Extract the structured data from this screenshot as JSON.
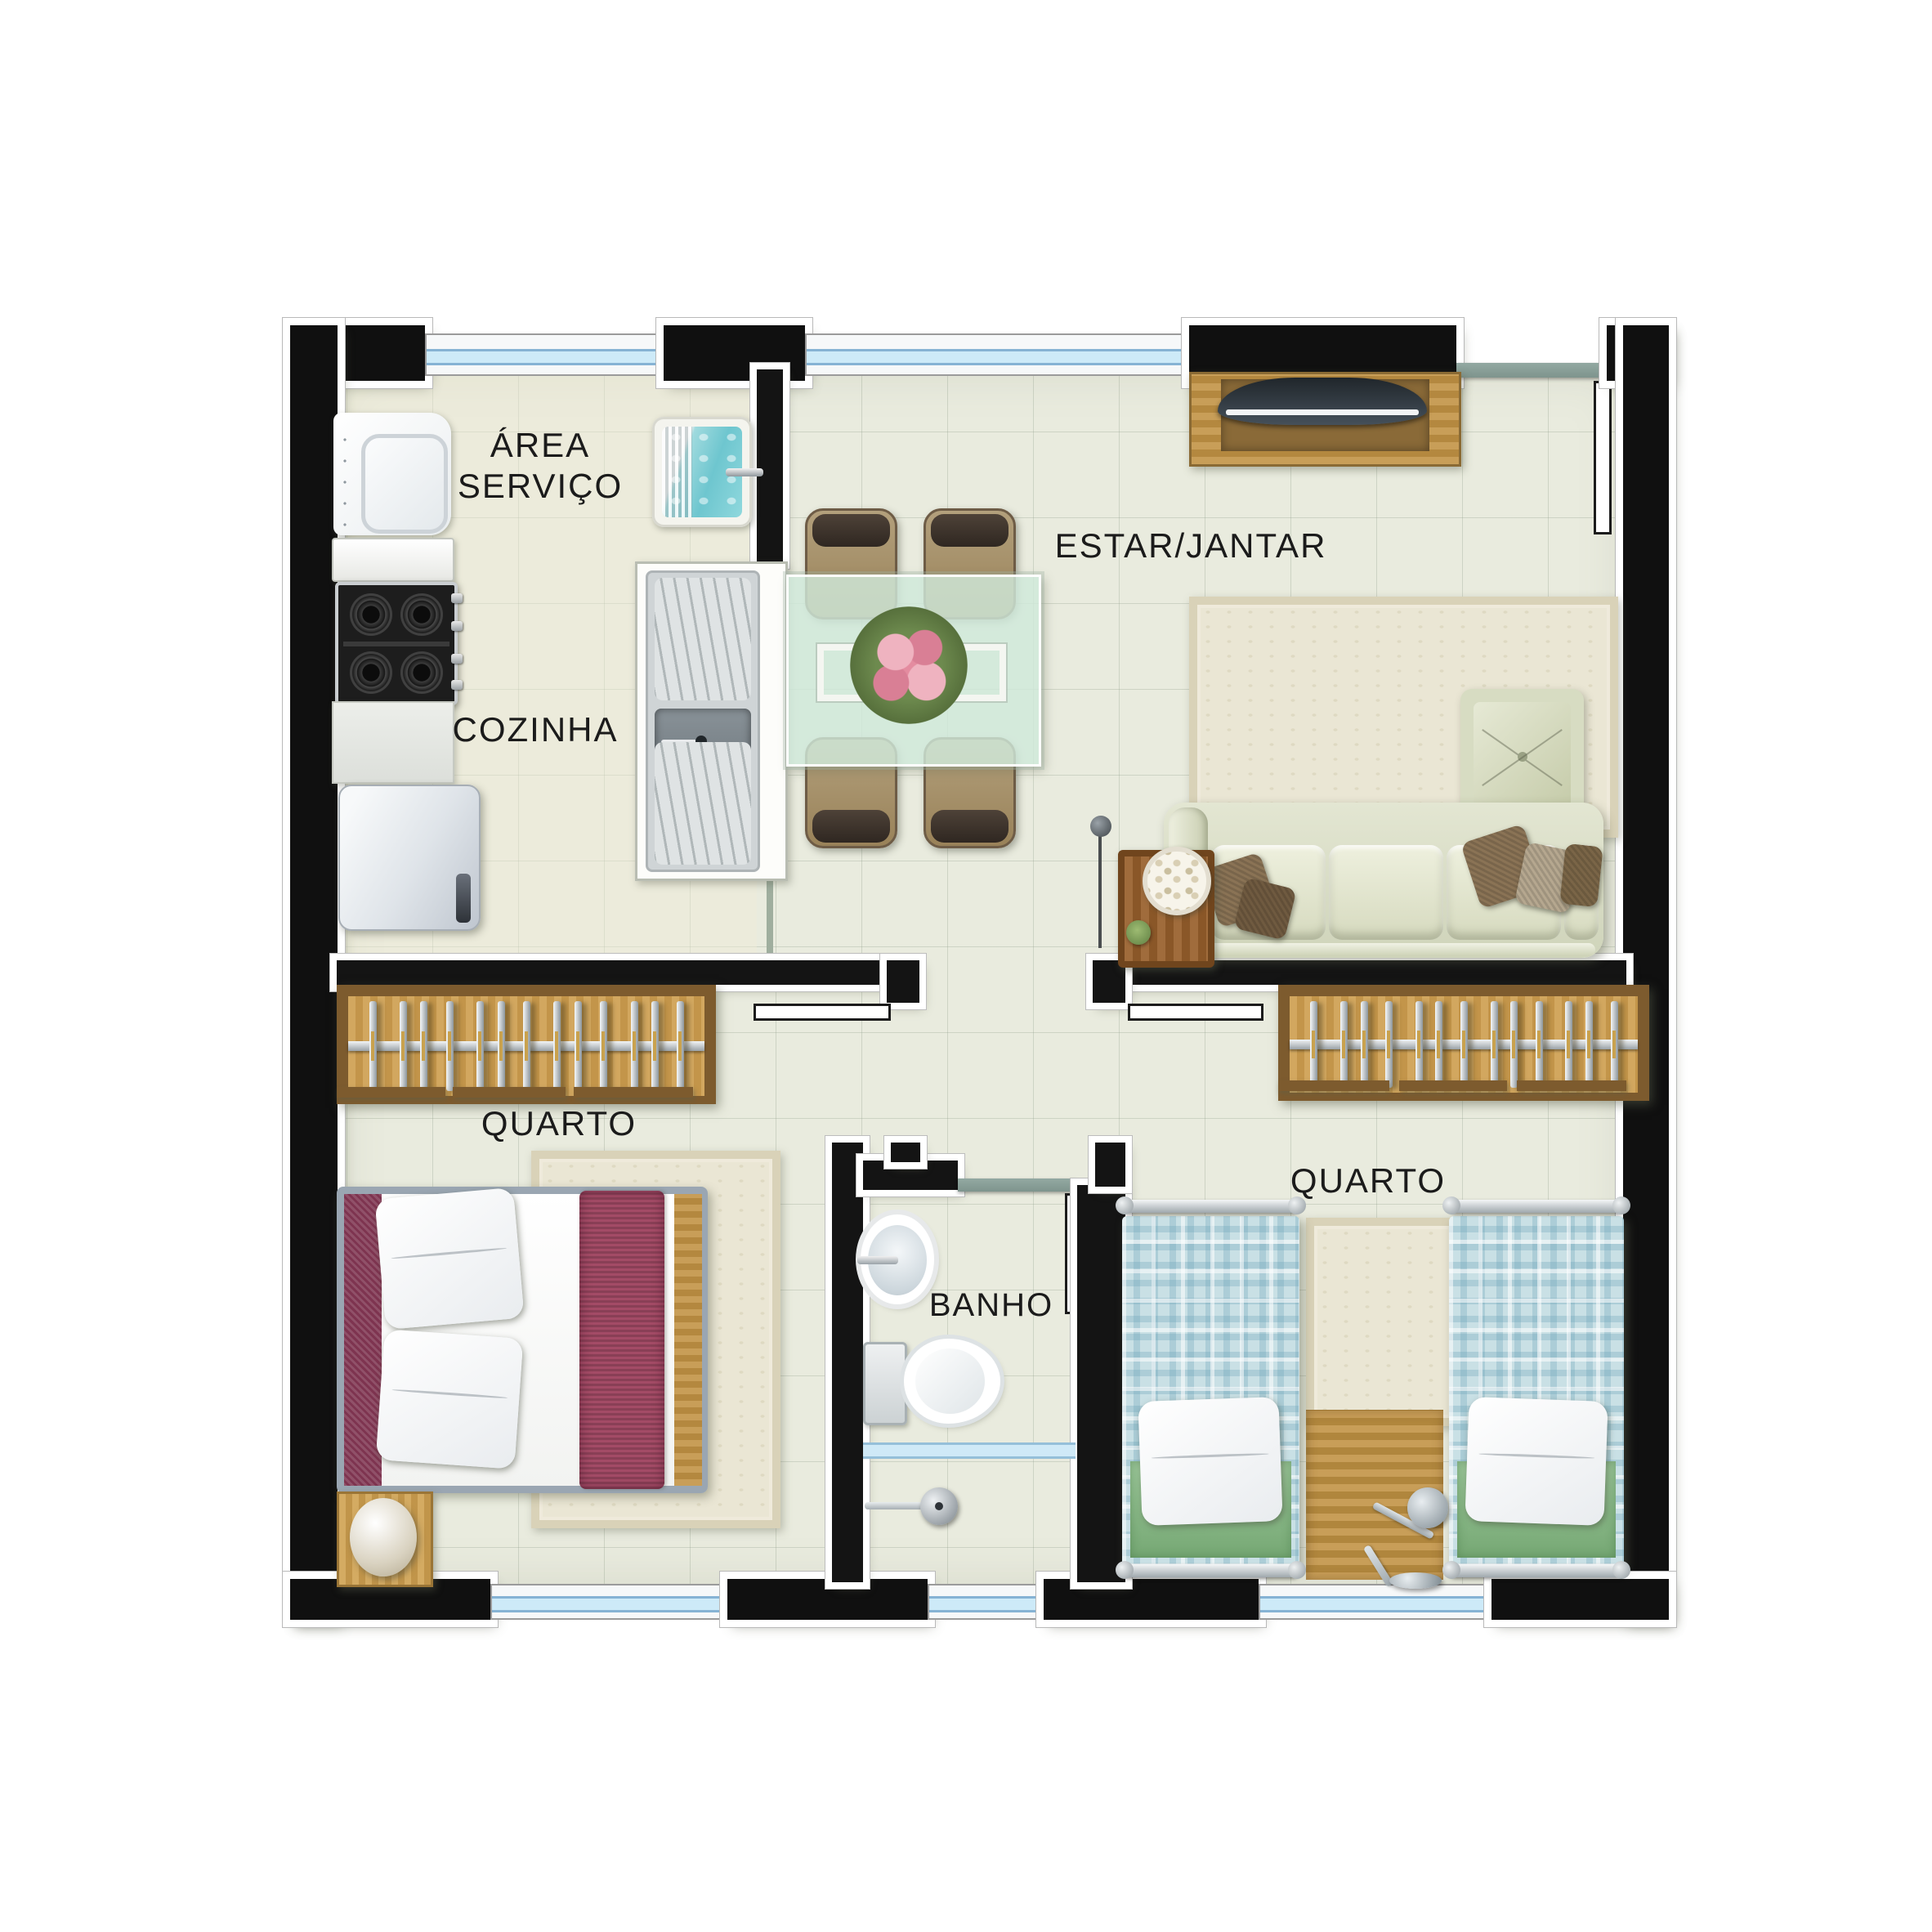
{
  "title": "Planta baixa apartamento 2 quartos",
  "labels": {
    "area_servico_line1": "ÁREA",
    "area_servico_line2": "SERVIÇO",
    "cozinha": "COZINHA",
    "estar_jantar": "ESTAR/JANTAR",
    "quarto_left": "QUARTO",
    "quarto_right": "QUARTO",
    "banho": "BANHO"
  },
  "colors": {
    "wall": "#101010",
    "wall_outline": "#ffffff",
    "floor": "#e9ebde",
    "windowblue": "#cdeaf8",
    "lintel_teal": "#87a09b",
    "wood": "#c89e58",
    "wood_dark": "#7d5b2e",
    "plaid_blue": "#c9e0e5",
    "blanket_green": "#8fbe8f",
    "maroon": "#a34b66",
    "maroon_dark": "#7e3450",
    "sofa_sage": "#dde1ca",
    "pillow_brown": "#8a7355",
    "rug_cream": "#eae6d4",
    "tanque_teal": "#7fcdd4",
    "glass_table_green": "#d0e9db"
  },
  "counts": {
    "wardrobe_left_hangers": 13,
    "wardrobe_right_hangers": 13,
    "dining_chairs": 4,
    "single_beds": 2,
    "sofa_cushions": 3
  }
}
